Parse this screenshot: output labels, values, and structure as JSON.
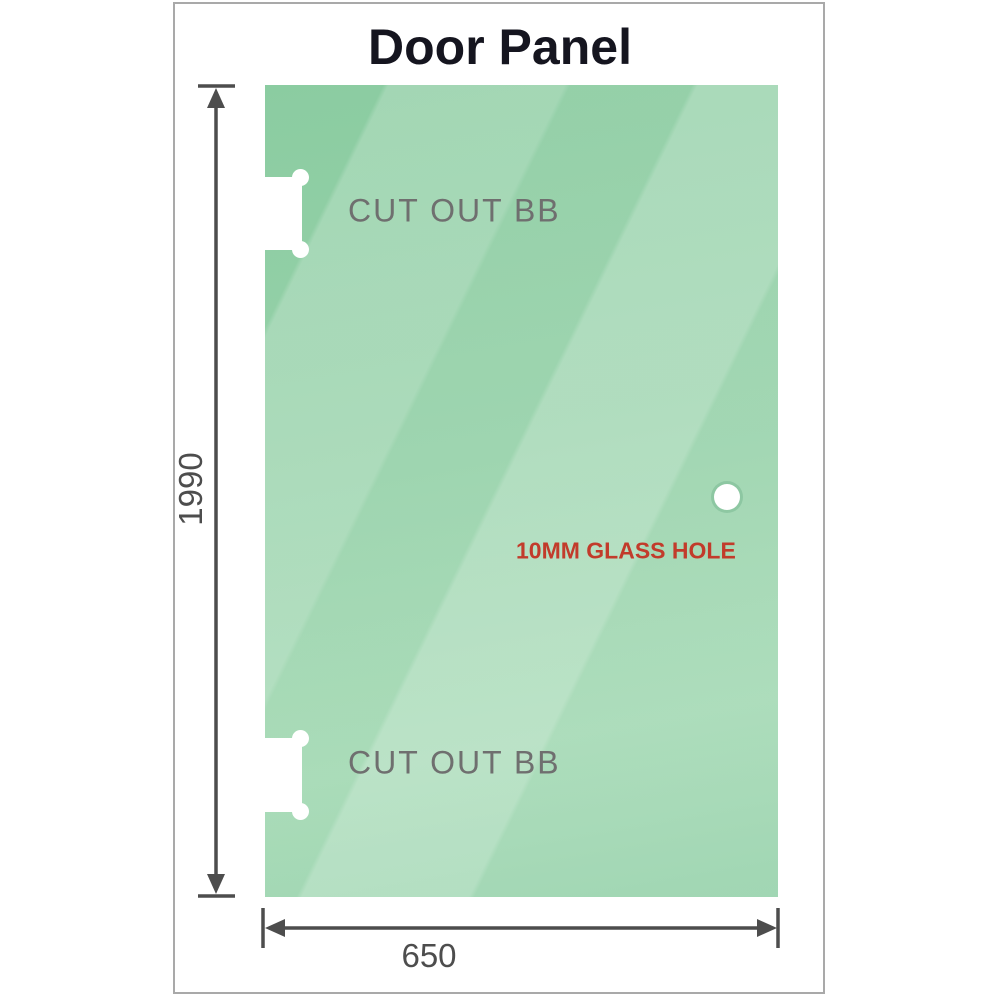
{
  "title": "Door Panel",
  "panel": {
    "height_label": "1990",
    "width_label": "650",
    "cutout_top_label": "CUT OUT BB",
    "cutout_bottom_label": "CUT OUT BB",
    "hole_label": "10MM GLASS HOLE"
  },
  "colors": {
    "title_color": "#15151f",
    "frame_border": "#a9a9a9",
    "glass_base": "#8bcca1",
    "glass_light": "#a4d9b4",
    "dimension": "#4d4d4d",
    "label_gray": "#6f6f6f",
    "hole_label_red": "#c23b2b"
  }
}
